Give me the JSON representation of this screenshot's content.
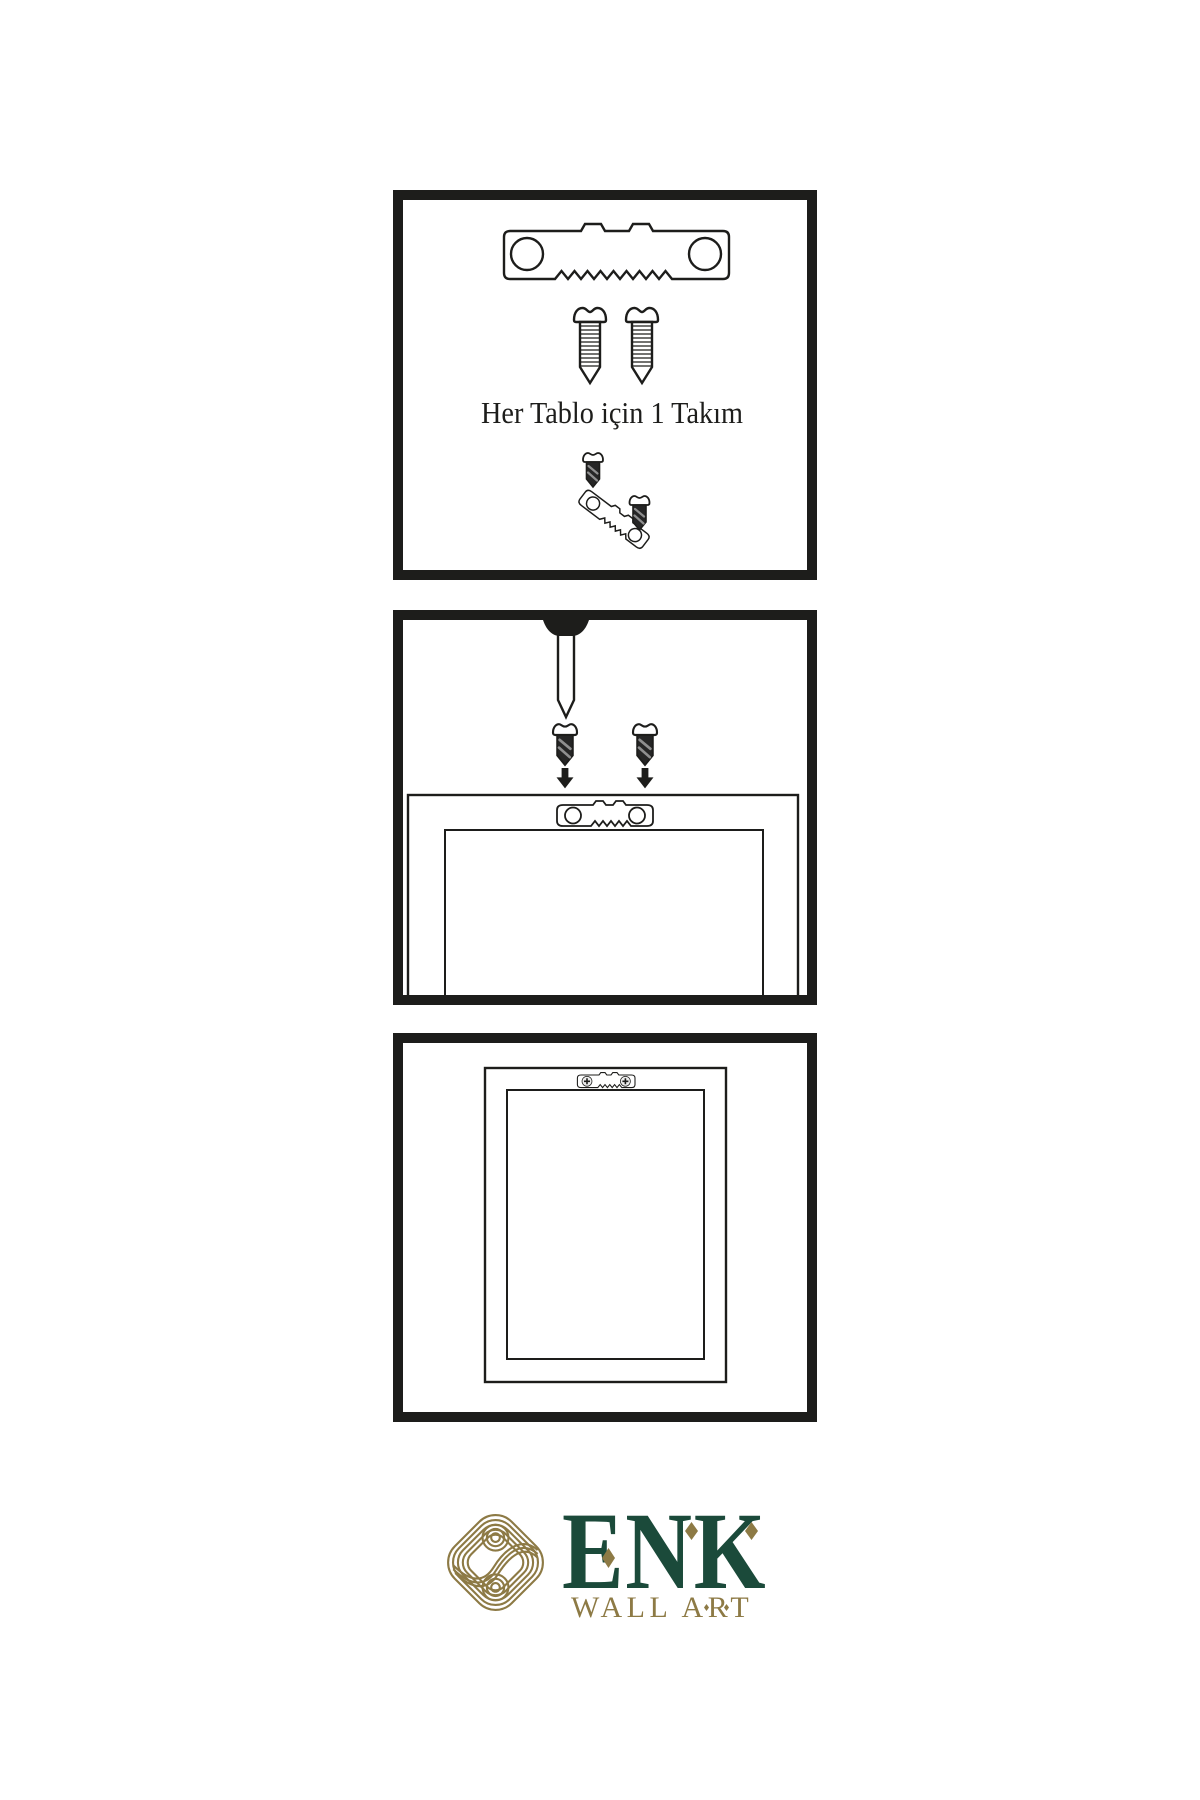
{
  "colors": {
    "paper": "#ffffff",
    "ink": "#1d1d1b",
    "logo_green": "#1b4a3a",
    "logo_gold": "#8d7a45"
  },
  "step1": {
    "caption": "Her Tablo için 1 Takım",
    "depicts": "hanging kit contents: one sawtooth hanger bar and two screws; small diagram of screws fastening into the hanger"
  },
  "step2": {
    "depicts": "nail driven into wall; two screws pointing down with arrows toward sawtooth hanger mounted on top of frame back"
  },
  "step3": {
    "depicts": "picture frame back hanging on wall by sawtooth hanger fixed with two screws"
  },
  "logo": {
    "brand": "ENK",
    "subtitle": "WALL ART"
  },
  "icons": {
    "sawtooth-hanger": "metal sawtooth hanger bar with two round screw holes",
    "screw": "threaded wood screw",
    "dark-screw": "screw shown filled dark",
    "nail": "wall nail with round head",
    "arrow-down": "solid downward arrow",
    "frame-back": "back of picture frame",
    "knot-emblem": "interlaced gold knot logo mark",
    "diamond-accent": "gold diamond accent"
  }
}
